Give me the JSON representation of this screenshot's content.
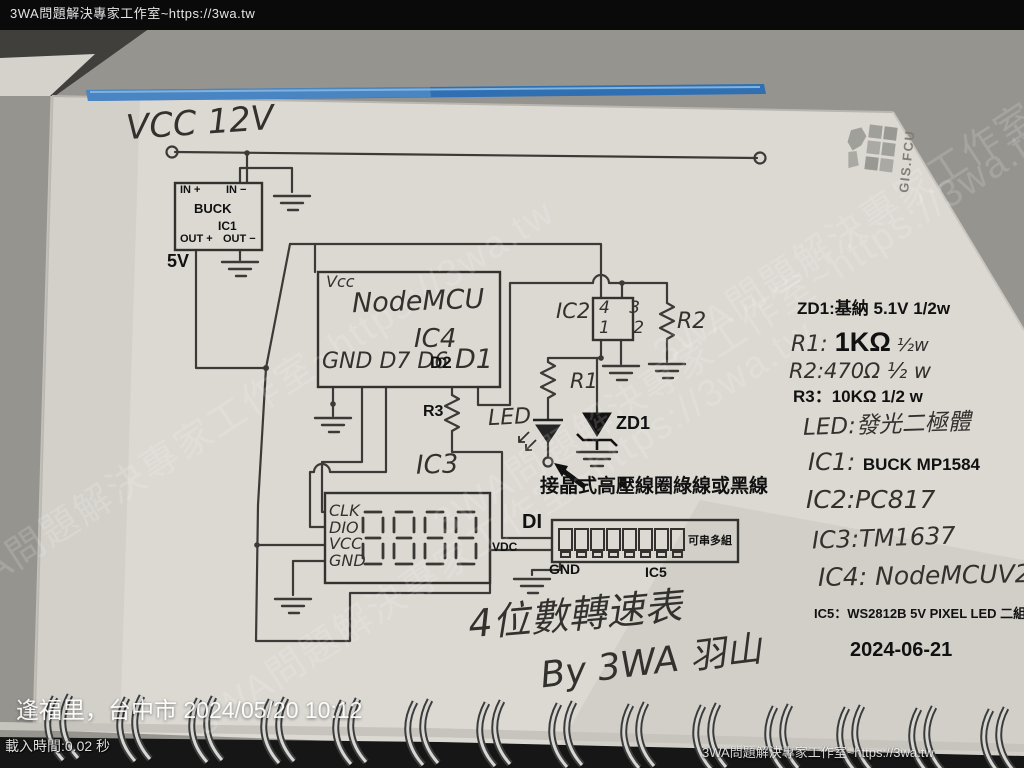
{
  "overlay": {
    "top_watermark": "3WA問題解決專家工作室~https://3wa.tw",
    "diagonal_watermark": "3WA問題解決專家工作室~https://3wa.tw",
    "bottom_right_watermark": "3WA問題解決專家工作室~https://3wa.tw",
    "location_timestamp": "逢福里，台中市  2024/05/20 10:12",
    "load_time": "載入時間:0.02 秒"
  },
  "stamp": {
    "text": "GIS.FCU"
  },
  "schematic": {
    "supply_label": "VCC 12V",
    "buck": {
      "pin_in_plus": "IN +",
      "pin_in_minus": "IN −",
      "name": "BUCK",
      "ref": "IC1",
      "pin_out_plus": "OUT +",
      "pin_out_minus": "OUT −",
      "rail_label": "5V"
    },
    "nodemcu": {
      "pin_vcc": "Vcc",
      "name": "NodeMCU",
      "ref": "IC4",
      "pins_left": "GND D7 D6",
      "pin_d2": "D2",
      "pin_d1": "D1"
    },
    "opto": {
      "ref": "IC2",
      "pins_top": "4 3",
      "pins_bottom": "1 2"
    },
    "display": {
      "ref": "IC3",
      "pins": "CLK\nDIO\nVCC\nGND"
    },
    "strip": {
      "ref": "IC5",
      "pin_di": "DI",
      "pin_vdc": "VDC",
      "pin_gnd": "GND",
      "chain_note": "可串多組"
    },
    "r1": "R1",
    "r2": "R2",
    "r3": "R3",
    "led_label": "LED",
    "zd1_label": "ZD1",
    "coil_note": "接晶式高壓線圈綠線或黑線",
    "title": "4位數轉速表",
    "byline": "By 3WA 羽山"
  },
  "notes": {
    "zd1": "ZD1:基納 5.1V 1/2w",
    "r1_pre": "R1: ",
    "r1_value": "1KΩ",
    "r1_post": " ½w",
    "r2": "R2:470Ω ½ w",
    "r3": "R3：10KΩ 1/2 w",
    "led": "LED:發光二極體",
    "ic1_pre": "IC1: ",
    "ic1_value": "BUCK MP1584",
    "ic2": "IC2:PC817",
    "ic3": "IC3:TM1637",
    "ic4": "IC4: NodeMCUV2",
    "ic5": "IC5：WS2812B 5V PIXEL LED 二組",
    "date": "2024-06-21"
  }
}
